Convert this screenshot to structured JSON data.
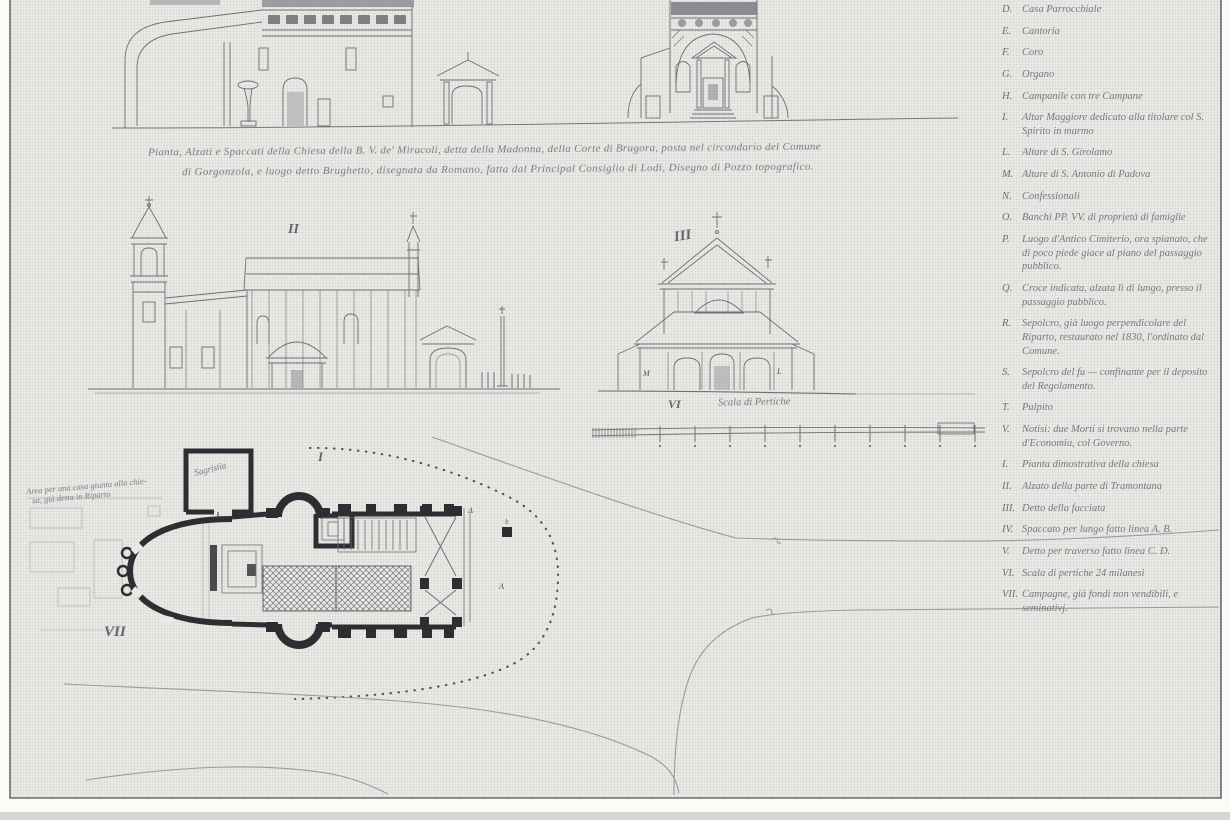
{
  "colors": {
    "paper": "#e9eae6",
    "ink": "#6c6c72",
    "ink_heavy": "#2e2e32",
    "handwriting": "#7b7b86"
  },
  "caption": {
    "line1": "Pianta, Alzati e Spaccati della Chiesa della B. V. de' Miracoli, detta della Madonna, della Corte di Brugora, posta nel circondario del Comune",
    "line2": "di Gorgonzola, e luogo detto Brughetto, disegnata da Romano, fatta dal Principal Consiglio di Lodi, Disegno di Pozzo topografico."
  },
  "figures": {
    "side_elevation_label": "II",
    "front_elevation_label": "III",
    "scale_label": "VI",
    "scale_title": "Scala di Pertiche",
    "plan_label": "I",
    "plan_area_label": "VII",
    "front_letter_left": "M",
    "front_letter_right": "L",
    "plan_letter_a1": "A",
    "plan_letter_a2": "A",
    "plan_letter_b": "b",
    "sacristy_note": "Sagristia",
    "area_note_line1": "Area per una casa giunta alla chie-",
    "area_note_line2": "sa, già detta in Riparto"
  },
  "legend": {
    "items": [
      {
        "key": "D.",
        "text": "Casa Parrocchiale"
      },
      {
        "key": "E.",
        "text": "Cantoria"
      },
      {
        "key": "F.",
        "text": "Coro"
      },
      {
        "key": "G.",
        "text": "Organo"
      },
      {
        "key": "H.",
        "text": "Campanile con tre Campane"
      },
      {
        "key": "I.",
        "text": "Altar Maggiore dedicato alla titolare col S. Spirito in marmo"
      },
      {
        "key": "L.",
        "text": "Altare di S. Girolamo"
      },
      {
        "key": "M.",
        "text": "Altare di S. Antonio di Padova"
      },
      {
        "key": "N.",
        "text": "Confessionali"
      },
      {
        "key": "O.",
        "text": "Banchi PP. VV. di proprietà di famiglie"
      },
      {
        "key": "P.",
        "text": "Luogo d'Antico Cimiterio, ora spianato, che di poco piede giace al piano del passaggio pubblico."
      },
      {
        "key": "Q.",
        "text": "Croce indicata, alzata lì di lungo, presso il passaggio pubblico."
      },
      {
        "key": "R.",
        "text": "Sepolcro, già luogo perpendicolare del Riparto, restaurato nel 1830, l'ordinato dal Comune."
      },
      {
        "key": "S.",
        "text": "Sepolcro del fu — confinante per il deposito del Regolamento."
      },
      {
        "key": "T.",
        "text": "Pulpito"
      },
      {
        "key": "V.",
        "text": "Notisi: due Morti si trovano nella parte d'Economia, col Governo."
      },
      {
        "key": "I.",
        "text": "Pianta dimostrativa della chiesa"
      },
      {
        "key": "II.",
        "text": "Alzato della parte di Tramontana"
      },
      {
        "key": "III.",
        "text": "Detto della facciata"
      },
      {
        "key": "IV.",
        "text": "Spaccato per lungo fatto linea A. B."
      },
      {
        "key": "V.",
        "text": "Detto per traverso fatto linea C. D."
      },
      {
        "key": "VI.",
        "text": "Scala di pertiche 24 milanesi"
      },
      {
        "key": "VII.",
        "text": "Campagne, già fondi non vendibili, e seminativj."
      }
    ]
  }
}
